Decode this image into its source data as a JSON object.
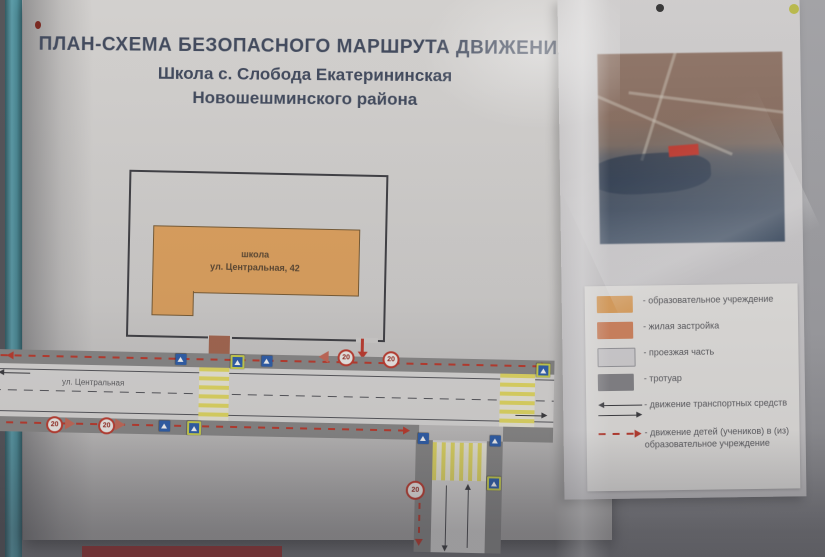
{
  "poster": {
    "title_line1": "ПЛАН-СХЕМА БЕЗОПАСНОГО МАРШРУТА ДВИЖЕНИЯ",
    "title_line2": "Школа с. Слобода Екатерининская",
    "title_line3": "Новошешминского района"
  },
  "map": {
    "school_label_line1": "школа",
    "school_label_line2": "ул. Центральная, 42",
    "street_label": "ул. Центральная",
    "speed_sign_text": "20"
  },
  "legend": {
    "items": [
      {
        "swatch": "education-building",
        "label": "- образовательное учреждение"
      },
      {
        "swatch": "residential",
        "label": "- жилая застройка"
      },
      {
        "swatch": "roadway",
        "label": "- проезжая часть"
      },
      {
        "swatch": "sidewalk",
        "label": "- тротуар"
      },
      {
        "swatch": "vehicle-traffic-arrows",
        "label": "- движение транспортных средств"
      },
      {
        "swatch": "children-route-arrow",
        "label": "- движение детей (учеников) в (из) образовательное учреждение"
      }
    ]
  },
  "colors": {
    "education_building": "#e4a55f",
    "residential": "#d8875f",
    "roadway": "#d8d6d4",
    "sidewalk": "#87868a",
    "children_route": "#c0392b",
    "vehicle_arrow": "#3a3a3e",
    "crosswalk_yellow": "#e9df63",
    "title_text": "#414a5e",
    "pipe_teal": "#4f93a0"
  }
}
